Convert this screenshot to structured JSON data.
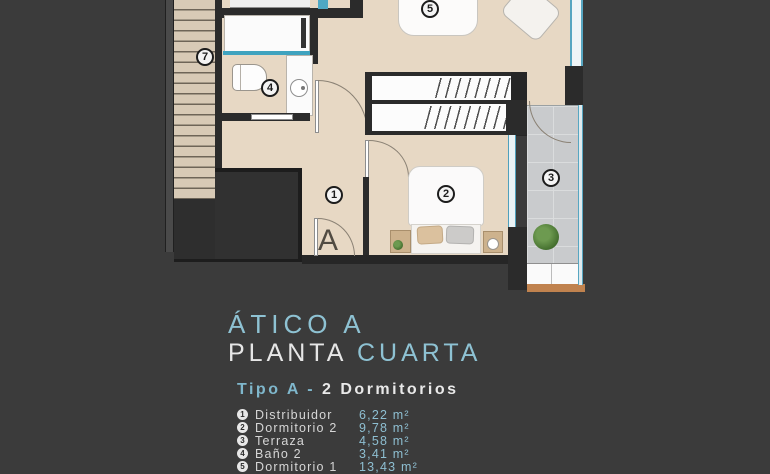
{
  "title": {
    "line1": "ÁTICO A",
    "line2_part1": "PLANTA",
    "line2_part2": "CUARTA"
  },
  "subtitle": {
    "part1": "Tipo A -",
    "part2": "2 Dormitorios"
  },
  "legend": [
    {
      "num": "1",
      "name": "Distribuidor",
      "area": "6,22 m²"
    },
    {
      "num": "2",
      "name": "Dormitorio 2",
      "area": "9,78 m²"
    },
    {
      "num": "3",
      "name": "Terraza",
      "area": "4,58 m²"
    },
    {
      "num": "4",
      "name": "Baño 2",
      "area": "3,41 m²"
    },
    {
      "num": "5",
      "name": "Dormitorio 1",
      "area": "13,43 m²"
    }
  ],
  "plan": {
    "marker": "A",
    "labels": {
      "hall": "1",
      "bedroom2": "2",
      "terrace": "3",
      "bath": "4",
      "room5": "5",
      "stairs": "7"
    }
  },
  "colors": {
    "background": "#3b3b3b",
    "accent": "#8ec2d3",
    "floor": "#e7d8c4",
    "wall": "#2b2b2b",
    "terrace": "#c9cbcd",
    "glass": "#52a7c2",
    "text": "#d9d9d9",
    "wood": "#c0824e"
  }
}
